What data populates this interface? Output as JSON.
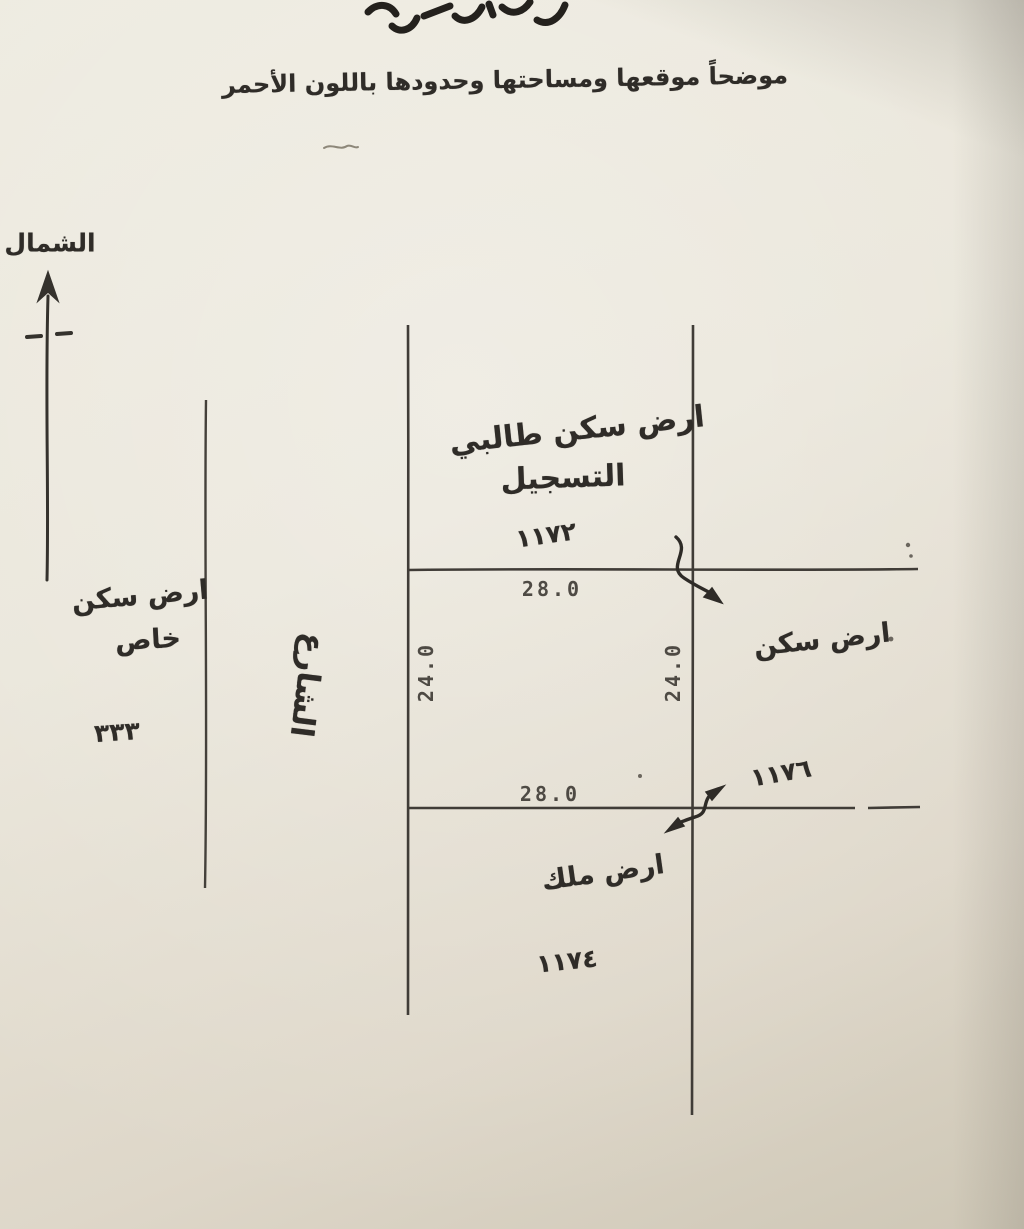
{
  "document": {
    "header": {
      "line2": "موضحاً موقعها ومساحتها وحدودها باللون الأحمر"
    },
    "compass": {
      "label": "الشمال"
    },
    "west_side": {
      "label_line1": "ارض سكن",
      "label_line2": "خاص",
      "plot_number": "٣٣٣"
    },
    "street": {
      "label": "الشارع"
    },
    "north_plot": {
      "label_line1": "ارض سكن طالبي",
      "label_line2": "التسجيل",
      "plot_number": "١١٧٢"
    },
    "east_plot": {
      "label": "ارض سكن",
      "plot_number": "١١٧٦"
    },
    "south_plot": {
      "label": "ارض ملك",
      "plot_number": "١١٧٤"
    },
    "dimensions": {
      "top": "28.0",
      "bottom": "28.0",
      "left": "24.0",
      "right": "24.0"
    },
    "colors": {
      "paper": "#e8e4d8",
      "ink": "#2f2c28",
      "line": "#403c37",
      "typed": "#4e4a44"
    }
  }
}
